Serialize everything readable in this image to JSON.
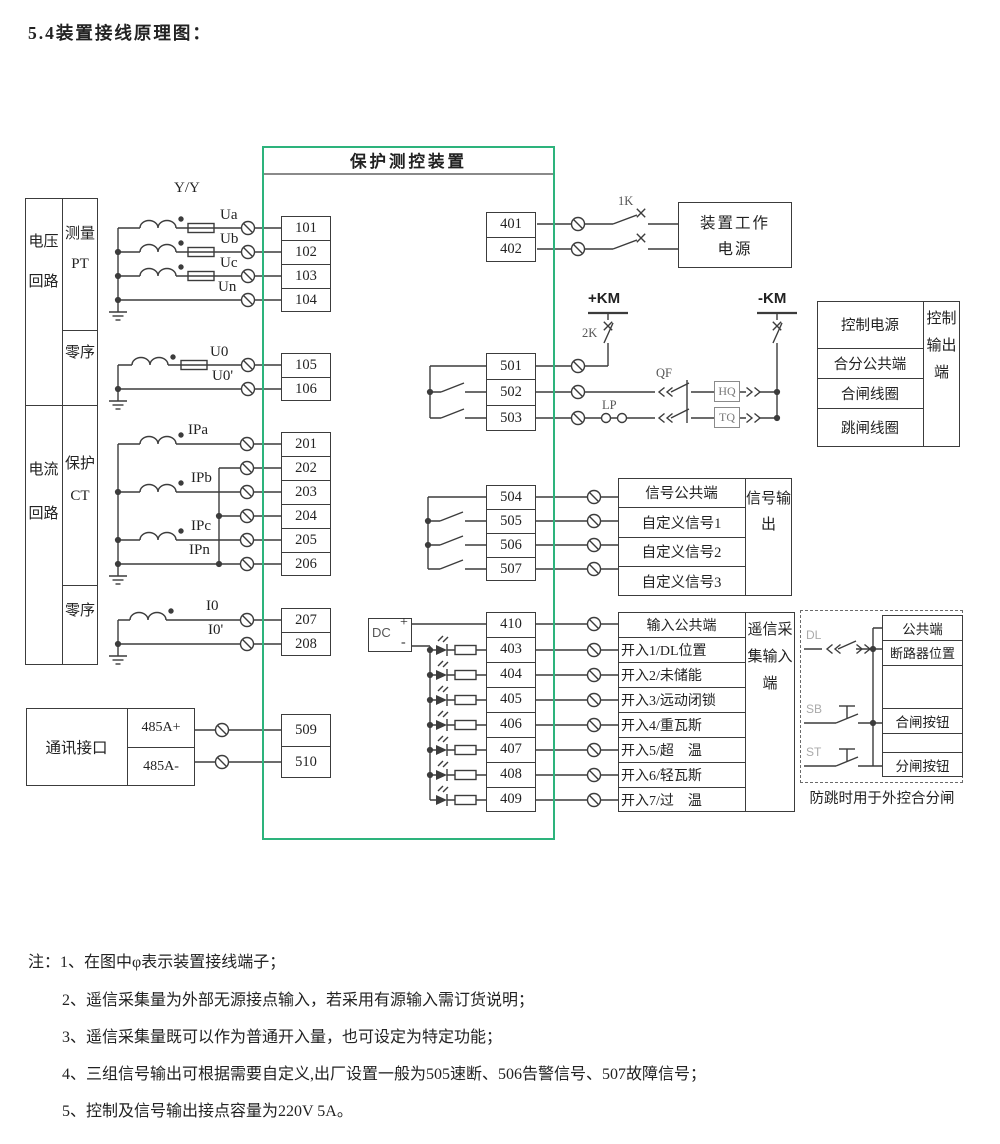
{
  "title": "5.4装置接线原理图：",
  "device": {
    "title": "保护测控装置",
    "border_color": "#2db37c"
  },
  "left_table": {
    "voltage_group": "电压回路",
    "current_group": "电流回路",
    "measure_pt": "测量PT",
    "voltage_zero": "零序",
    "protect_ct": "保护CT",
    "current_zero": "零序"
  },
  "comm": {
    "name": "通讯接口",
    "port_a": "485A+",
    "port_b": "485A-"
  },
  "wire_labels": {
    "yy": "Y/Y",
    "ua": "Ua",
    "ub": "Ub",
    "uc": "Uc",
    "un": "Un",
    "u0": "U0",
    "u0p": "U0'",
    "ipa": "IPa",
    "ipb": "IPb",
    "ipc": "IPc",
    "ipn": "IPn",
    "i0": "I0",
    "i0p": "I0'"
  },
  "terminals": {
    "voltage": [
      "101",
      "102",
      "103",
      "104"
    ],
    "voltage_zero": [
      "105",
      "106"
    ],
    "current": [
      "201",
      "202",
      "203",
      "204",
      "205",
      "206"
    ],
    "current_zero": [
      "207",
      "208"
    ],
    "comm": [
      "509",
      "510"
    ],
    "power": [
      "401",
      "402"
    ],
    "control": [
      "501",
      "502",
      "503"
    ],
    "signal": [
      "504",
      "505",
      "506",
      "507"
    ],
    "binary_input": [
      "410",
      "403",
      "404",
      "405",
      "406",
      "407",
      "408",
      "409"
    ]
  },
  "power_box": {
    "line1": "装置工作",
    "line2": "电源"
  },
  "symbols": {
    "k1": "1K",
    "k2": "2K",
    "km_pos": "+KM",
    "km_neg": "-KM",
    "qf": "QF",
    "lp": "LP",
    "hq": "HQ",
    "tq": "TQ",
    "dc": "DC",
    "plus": "+",
    "minus": "-",
    "dl": "DL",
    "sb": "SB",
    "st": "ST"
  },
  "control_table": {
    "rows": [
      "控制电源",
      "合分公共端",
      "合闸线圈",
      "跳闸线圈"
    ],
    "side": "控制输出端"
  },
  "signal_table": {
    "rows": [
      "信号公共端",
      "自定义信号1",
      "自定义信号2",
      "自定义信号3"
    ],
    "side": "信号输出"
  },
  "input_table": {
    "rows": [
      "输入公共端",
      "开入1/DL位置",
      "开入2/未储能",
      "开入3/远动闭锁",
      "开入4/重瓦斯",
      "开入5/超　温",
      "开入6/轻瓦斯",
      "开入7/过　温"
    ],
    "side": "遥信采集输入端"
  },
  "external_box": {
    "rows": [
      "公共端",
      "断路器位置",
      "合闸按钮",
      "分闸按钮"
    ],
    "caption": "防跳时用于外控合分闸"
  },
  "notes": [
    "注：1、在图中φ表示装置接线端子；",
    "2、遥信采集量为外部无源接点输入，若采用有源输入需订货说明；",
    "3、遥信采集量既可以作为普通开入量，也可设定为特定功能；",
    "4、三组信号输出可根据需要自定义,出厂设置一般为505速断、506告警信号、507故障信号；",
    "5、控制及信号输出接点容量为220V 5A。"
  ]
}
